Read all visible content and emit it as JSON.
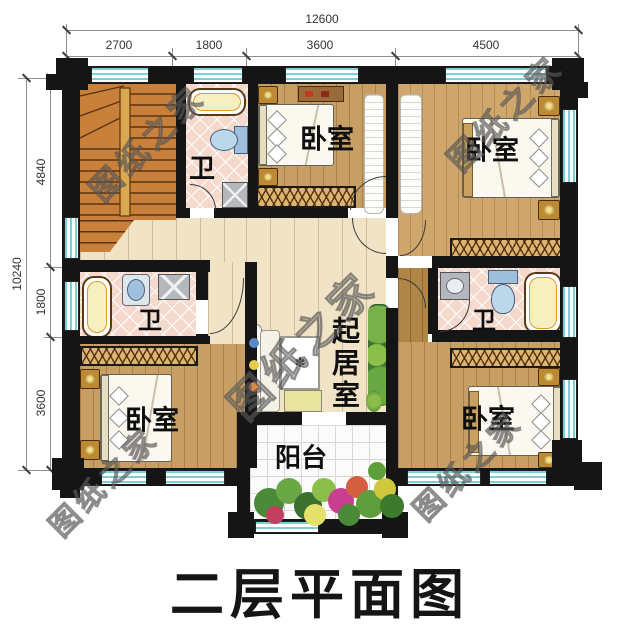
{
  "title": "二层平面图",
  "watermark": "图纸之家",
  "dimensions": {
    "top": {
      "total": "12600",
      "segments": [
        "2700",
        "1800",
        "3600",
        "4500"
      ]
    },
    "left": {
      "total": "10240",
      "segments": [
        "4840",
        "1800",
        "3600"
      ]
    }
  },
  "rooms": {
    "bath_top": "卫",
    "bath_left": "卫",
    "bath_right": "卫",
    "bedroom_top_middle": "卧室",
    "bedroom_top_right": "卧室",
    "bedroom_bottom_left": "卧室",
    "bedroom_bottom_right": "卧室",
    "living_room": "起居室",
    "balcony": "阳台"
  },
  "colors": {
    "wall": "#151515",
    "window_glass": "#7ecfd2",
    "wood_floor": "#c79e63",
    "hall_floor": "#f0e3c6",
    "tile_floor": "#f6d9cd",
    "stair_wood": "#c9803a"
  }
}
